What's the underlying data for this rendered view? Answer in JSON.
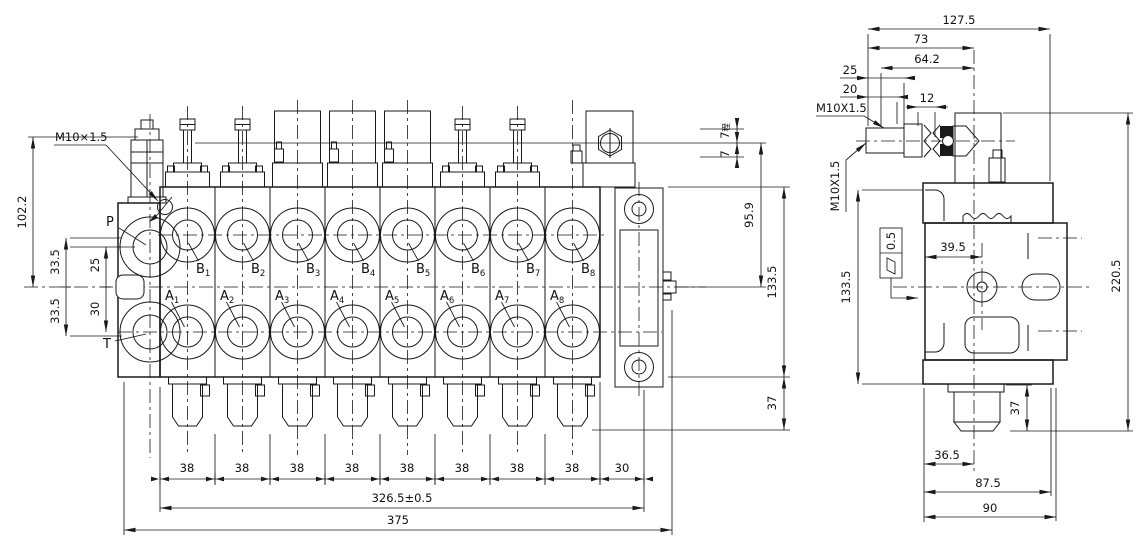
{
  "colors": {
    "ink": "#1a1a1a",
    "background": "#ffffff"
  },
  "front_view": {
    "ports": {
      "p": "P",
      "t": "T",
      "b_prefix": "B",
      "a_prefix": "A",
      "numbers": [
        "1",
        "2",
        "3",
        "4",
        "5",
        "6",
        "7",
        "8"
      ]
    },
    "dims": {
      "thread": "M10×1.5",
      "overall_height": "102.2",
      "port_off_top": "33.5",
      "p_to_center": "25",
      "center_to_t": "30",
      "port_off_bottom": "33.5",
      "stroke_up": "7",
      "stroke_note": "程",
      "stroke_down": "7",
      "top_to_center": "95.9",
      "body_height": "133.5",
      "cap_height": "37",
      "pitch": [
        "38",
        "38",
        "38",
        "38",
        "38",
        "38",
        "38",
        "38",
        "30"
      ],
      "stack_length": "326.5±0.5",
      "overall_length": "375"
    }
  },
  "side_view": {
    "dims": {
      "overall_width": "127.5",
      "w73": "73",
      "w642": "64.2",
      "w25": "25",
      "w20": "20",
      "thread_top": "M10X1.5",
      "w12": "12",
      "thread_left": "M10X1.5",
      "hole_offset": "39.5",
      "body_height": "133.5",
      "overall_height": "220.5",
      "cap_height": "37",
      "cap_offset": "36.5",
      "w875": "87.5",
      "w90": "90"
    },
    "flatness": {
      "value": "0.5"
    }
  }
}
